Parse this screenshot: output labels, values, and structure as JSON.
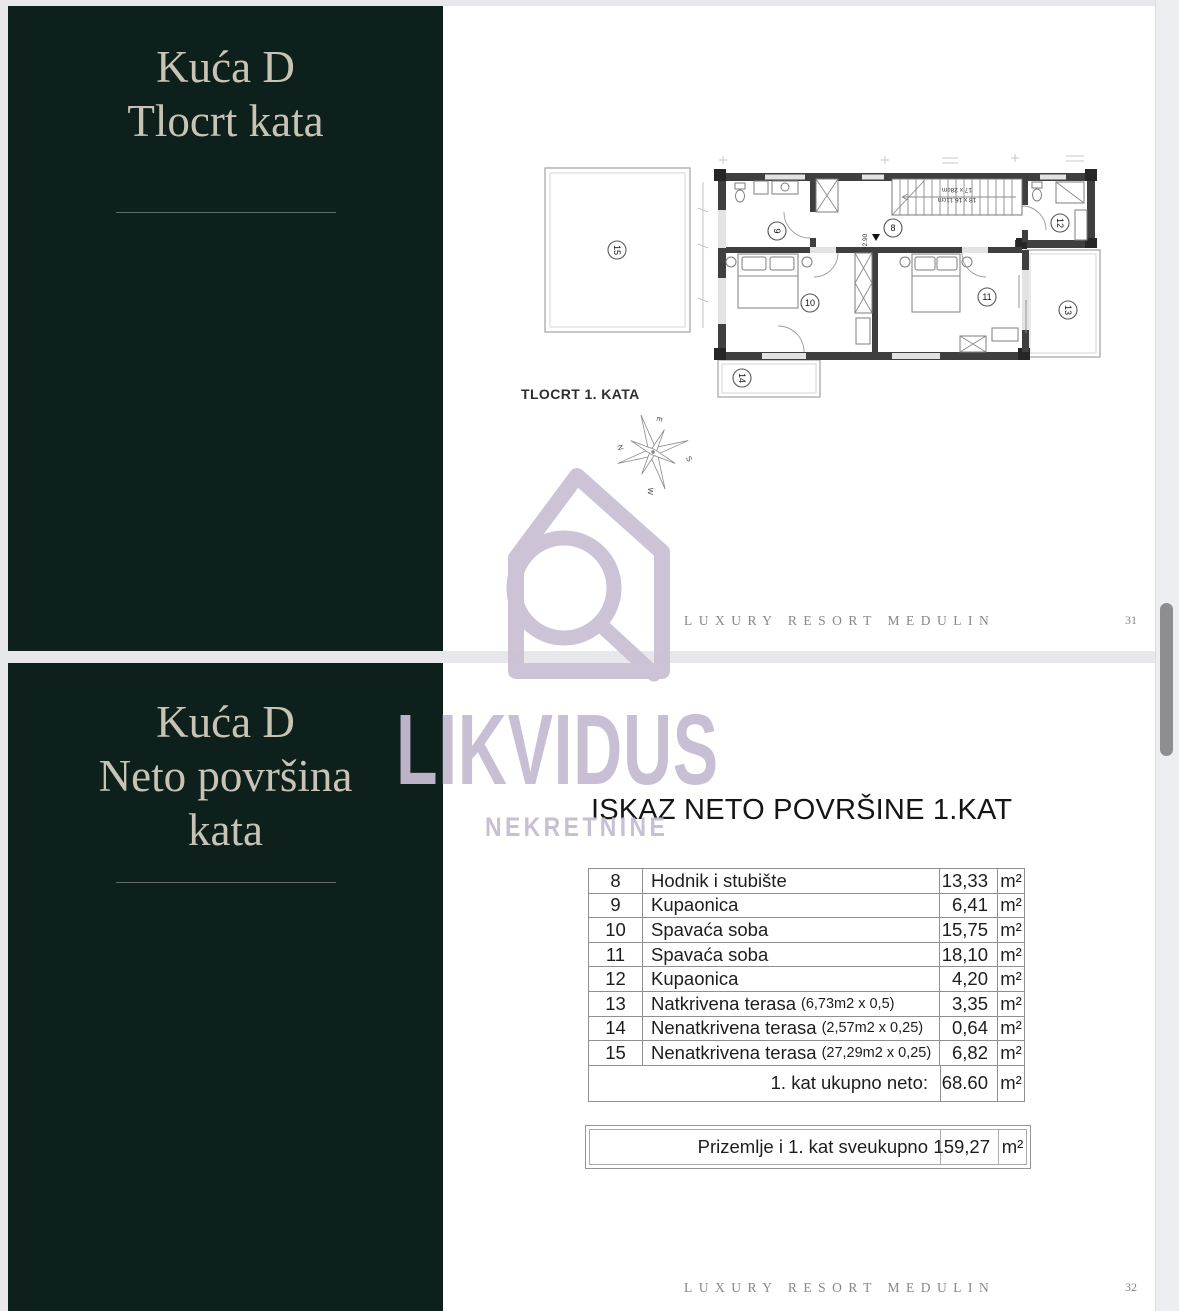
{
  "page_floor_plan": {
    "sidebar": {
      "line1": "Kuća D",
      "line2": "Tlocrt kata"
    },
    "plan_caption": "TLOCRT 1. KATA",
    "footer_text": "LUXURY RESORT MEDULIN",
    "page_number": "31",
    "plan": {
      "rooms": {
        "hall": "8",
        "bath1": "9",
        "bed1": "10",
        "bed2": "11",
        "bath2": "12",
        "terrace_right": "13",
        "terrace_small": "14",
        "terrace_large": "15"
      },
      "level_mark": "+2.90",
      "stair_note_line1": "18 x 16,11cm",
      "stair_note_line2": "17 x 28cm",
      "compass": {
        "top": "E",
        "right": "S",
        "bottom": "W",
        "left": "N"
      }
    }
  },
  "page_net_area": {
    "sidebar": {
      "line1": "Kuća D",
      "line2": "Neto površina",
      "line3": "kata"
    },
    "table_title": "ISKAZ NETO POVRŠINE 1.KAT",
    "rows": [
      {
        "no": "8",
        "name": "Hodnik i stubište",
        "note": "",
        "value": "13,33",
        "unit": "m²"
      },
      {
        "no": "9",
        "name": "Kupaonica",
        "note": "",
        "value": "6,41",
        "unit": "m²"
      },
      {
        "no": "10",
        "name": "Spavaća soba",
        "note": "",
        "value": "15,75",
        "unit": "m²"
      },
      {
        "no": "11",
        "name": "Spavaća soba",
        "note": "",
        "value": "18,10",
        "unit": "m²"
      },
      {
        "no": "12",
        "name": "Kupaonica",
        "note": "",
        "value": "4,20",
        "unit": "m²"
      },
      {
        "no": "13",
        "name": "Natkrivena terasa",
        "note": "(6,73m2 x 0,5)",
        "value": "3,35",
        "unit": "m²"
      },
      {
        "no": "14",
        "name": "Nenatkrivena terasa",
        "note": "(2,57m2 x 0,25)",
        "value": "0,64",
        "unit": "m²"
      },
      {
        "no": "15",
        "name": "Nenatkrivena terasa",
        "note": "(27,29m2 x 0,25)",
        "value": "6,82",
        "unit": "m²"
      }
    ],
    "total_row": {
      "label": "1. kat ukupno neto:",
      "value": "68.60",
      "unit": "m²"
    },
    "summary_row": {
      "label": "Prizemlje i 1. kat sveukupno",
      "value": "159,27",
      "unit": "m²"
    },
    "footer_text": "LUXURY RESORT MEDULIN",
    "page_number": "32"
  },
  "watermark": {
    "brand": "LIKVIDUS",
    "subtitle": "NEKRETNINE"
  },
  "colors": {
    "sidebar": "#0d201b",
    "watermark_purple": "#c6bcd2",
    "table_border": "#8f8f8f"
  }
}
